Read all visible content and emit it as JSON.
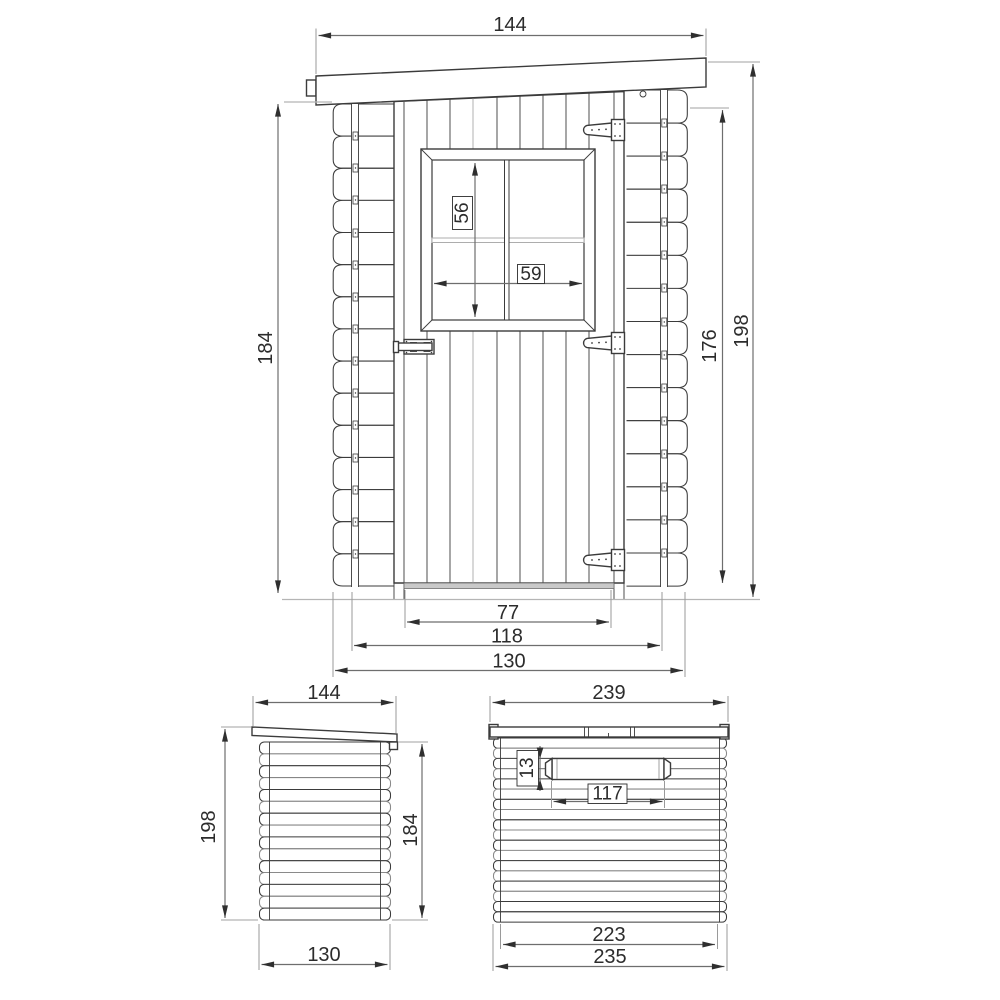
{
  "front_view": {
    "roof_width": "144",
    "wall_height_left": "184",
    "overall_height": "198",
    "wall_height_right": "176",
    "window_height": "56",
    "window_width": "59",
    "door_width": "77",
    "frame_width": "118",
    "base_width": "130"
  },
  "side_view": {
    "roof_depth": "144",
    "overall_height": "198",
    "wall_height": "184",
    "base_depth": "130"
  },
  "top_view": {
    "roof_width": "239",
    "batten_thickness": "13",
    "batten_length": "117",
    "inner_width": "223",
    "outer_width": "235"
  },
  "colors": {
    "line": "#3b3b3b",
    "dimension_line": "#6e6e6e",
    "light_line": "#b5b5b5",
    "text": "#2c2c2c",
    "background": "#ffffff"
  }
}
